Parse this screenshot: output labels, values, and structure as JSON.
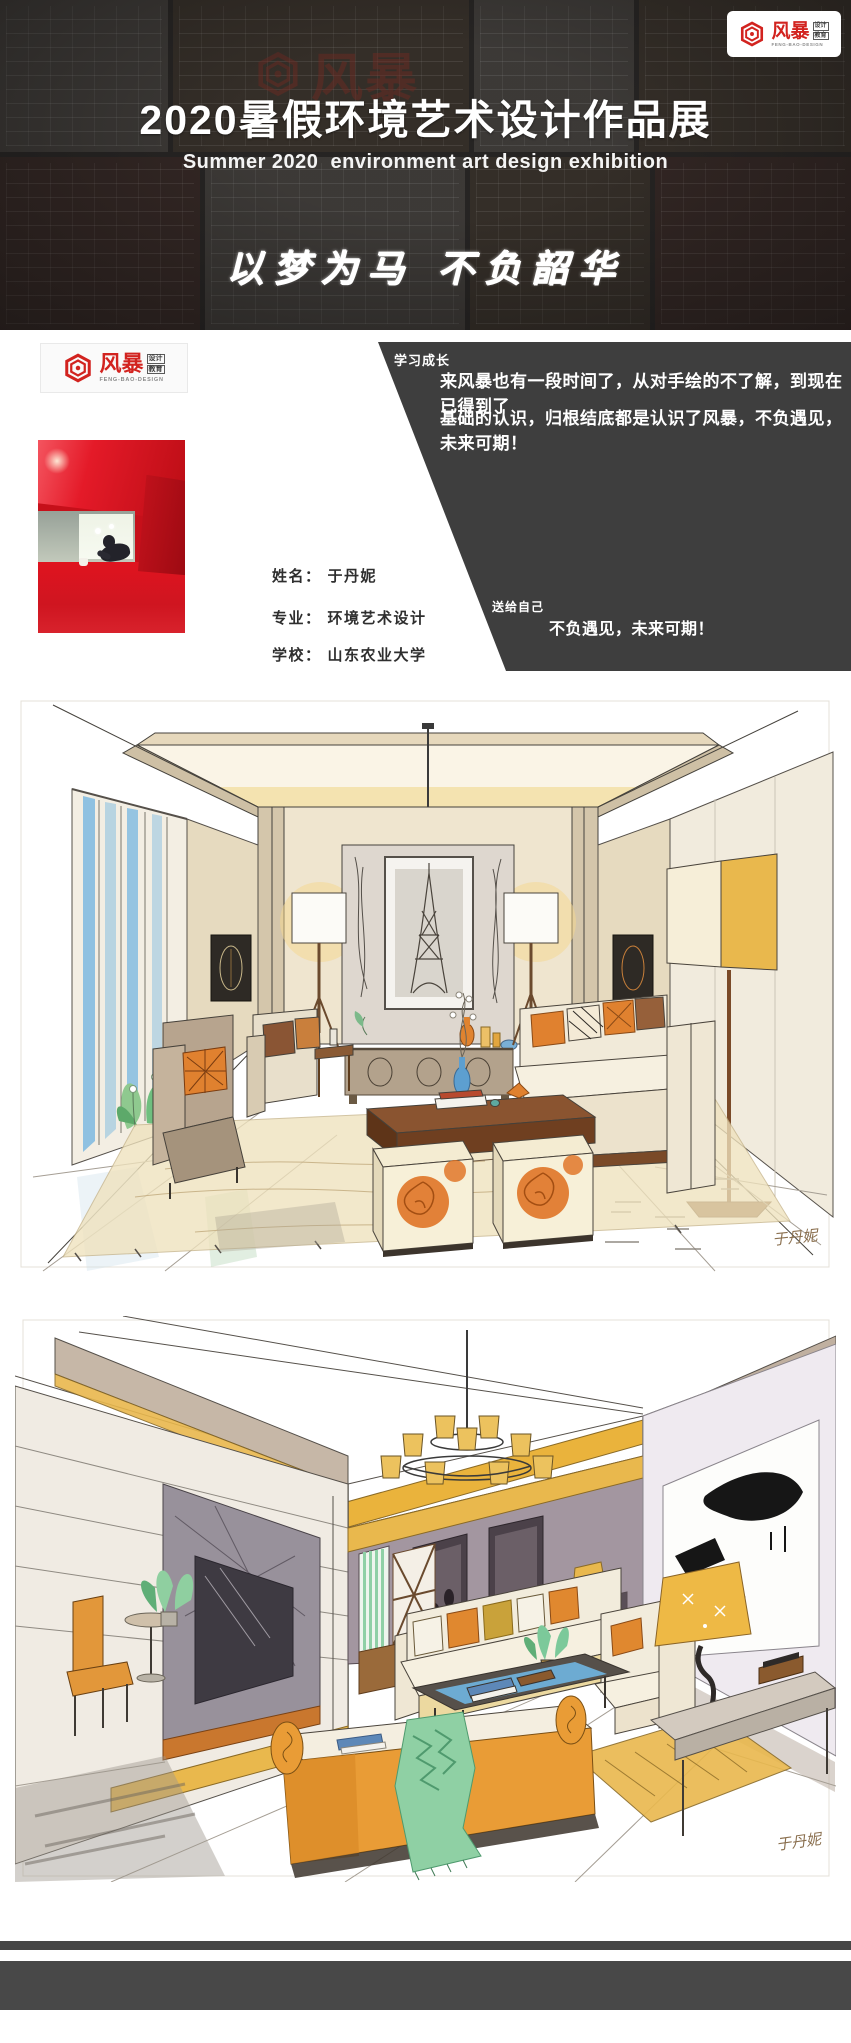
{
  "header": {
    "title": "2020暑假环境艺术设计作品展",
    "subtitle": "Summer 2020  environment art design exhibition",
    "motto": "以梦为马  不负韶华",
    "watermark_cn": "风暴"
  },
  "brand": {
    "name_cn": "风暴",
    "sub_cn_1": "设计",
    "sub_cn_2": "教育",
    "name_en": "FENG-BAO-DESIGN"
  },
  "profile": {
    "growth": {
      "label": "学习成长",
      "line1": "来风暴也有一段时间了，从对手绘的不了解，到现在已得到了",
      "line2": "基础的认识，归根结底都是认识了风暴，不负遇见，未来可期！"
    },
    "gift": {
      "label": "送给自己",
      "text": "不负遇见，未来可期！"
    },
    "fields": [
      {
        "label": "姓名：",
        "value": "于丹妮"
      },
      {
        "label": "专业：",
        "value": "环境艺术设计"
      },
      {
        "label": "学校：",
        "value": "山东农业大学"
      }
    ]
  },
  "artworks": [
    {
      "signature": "于丹妮"
    },
    {
      "signature": "于丹妮"
    }
  ],
  "colors": {
    "brand_red": "#d2231f",
    "header_bg": "#262423",
    "panel_dark": "#3e3e3e",
    "marker_yellow": "#e9b84d",
    "marker_orange": "#e0812f",
    "photo_red": "#d31722",
    "footer_bar": "#484848"
  }
}
